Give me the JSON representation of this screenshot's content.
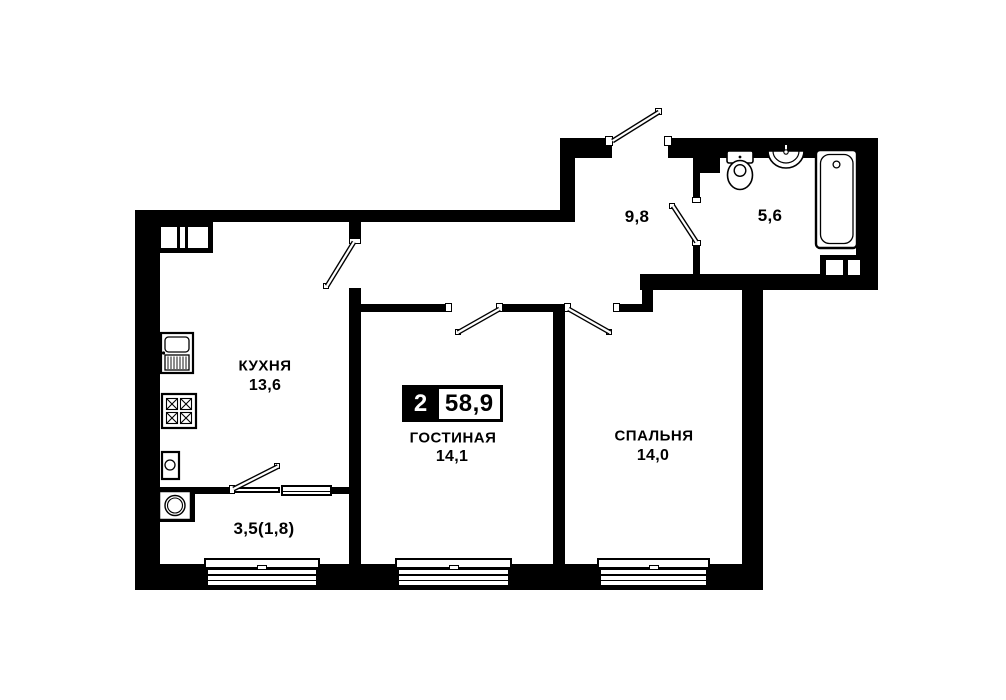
{
  "plan": {
    "badge": {
      "rooms_count": "2",
      "total_area": "58,9"
    },
    "rooms": {
      "kitchen": {
        "name": "КУХНЯ",
        "area": "13,6"
      },
      "living": {
        "name": "ГОСТИНАЯ",
        "area": "14,1"
      },
      "bedroom": {
        "name": "СПАЛЬНЯ",
        "area": "14,0"
      },
      "hallway": {
        "area": "9,8"
      },
      "bathroom": {
        "area": "5,6"
      },
      "balcony": {
        "area": "3,5(1,8)"
      }
    },
    "colors": {
      "wall": "#000000",
      "background": "#ffffff"
    },
    "icons": [
      "toilet-icon",
      "bath-sink-icon",
      "bathtub-icon",
      "kitchen-sink-icon",
      "stove-icon",
      "water-heater-icon",
      "washing-machine-icon",
      "vent-shaft-icon",
      "door-swing-icon",
      "window-icon"
    ]
  }
}
